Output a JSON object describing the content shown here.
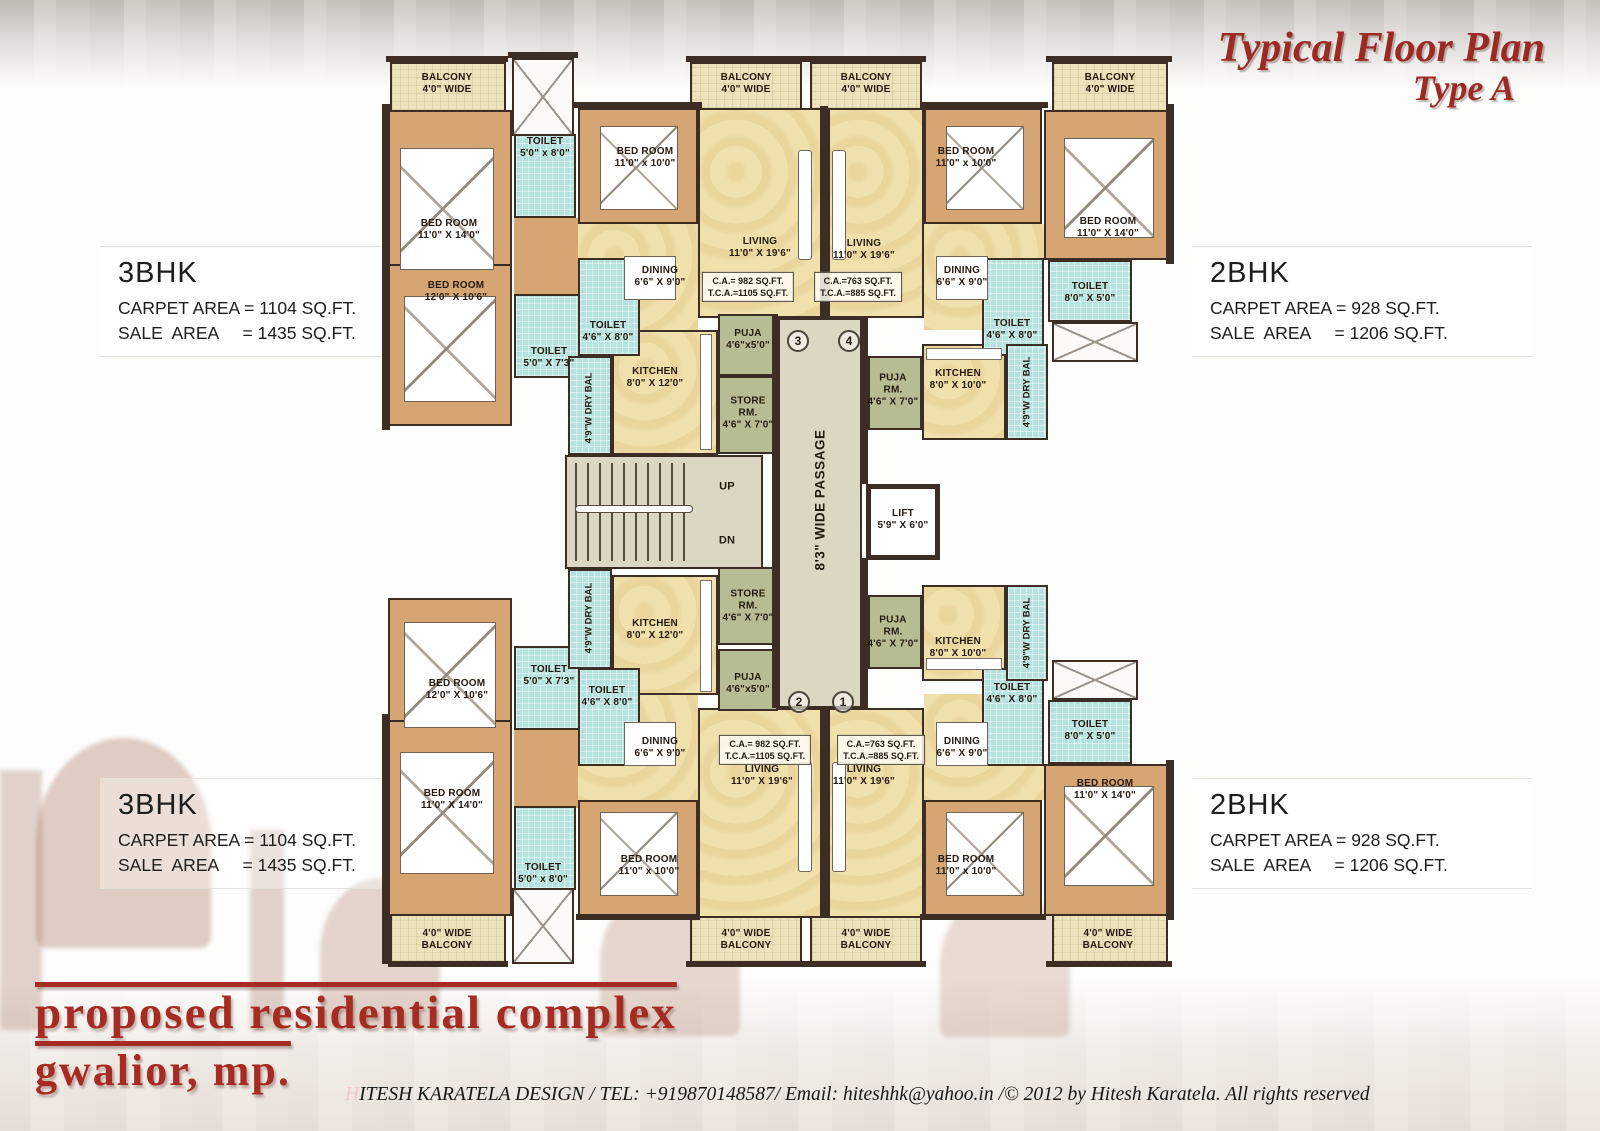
{
  "title": {
    "line1": "Typical Floor Plan",
    "line2": "Type A"
  },
  "info_blocks": {
    "top_left": {
      "name": "3BHK",
      "carpet": "CARPET AREA = 1104 SQ.FT.",
      "sale": "SALE  AREA     = 1435 SQ.FT."
    },
    "top_right": {
      "name": "2BHK",
      "carpet": "CARPET AREA = 928 SQ.FT.",
      "sale": "SALE  AREA     = 1206 SQ.FT."
    },
    "bottom_left": {
      "name": "3BHK",
      "carpet": "CARPET AREA = 1104 SQ.FT.",
      "sale": "SALE  AREA     = 1435 SQ.FT."
    },
    "bottom_right": {
      "name": "2BHK",
      "carpet": "CARPET AREA = 928 SQ.FT.",
      "sale": "SALE  AREA     = 1206 SQ.FT."
    }
  },
  "rooms": {
    "balcony": {
      "l1": "BALCONY",
      "l2": "4'0\" WIDE"
    },
    "balcony_b": {
      "l1": "4'0\" WIDE",
      "l2": "BALCONY"
    },
    "bed_11x14": {
      "l1": "BED ROOM",
      "l2": "11'0\" X 14'0\""
    },
    "bed_11x10": {
      "l1": "BED ROOM",
      "l2": "11'0\" x 10'0\""
    },
    "bed_12x10_6": {
      "l1": "BED ROOM",
      "l2": "12'0\" X 10'6\""
    },
    "living": {
      "l1": "LIVING",
      "l2": "11'0\" X 19'6\""
    },
    "dining": {
      "l1": "DINING",
      "l2": "6'6\" X 9'0\""
    },
    "kitchen_8x12": {
      "l1": "KITCHEN",
      "l2": "8'0\" X 12'0\""
    },
    "kitchen_8x10": {
      "l1": "KITCHEN",
      "l2": "8'0\" X 10'0\""
    },
    "toilet_5x8": {
      "l1": "TOILET",
      "l2": "5'0\" x 8'0\""
    },
    "toilet_4_6x8": {
      "l1": "TOILET",
      "l2": "4'6\" X 8'0\""
    },
    "toilet_5x7_3": {
      "l1": "TOILET",
      "l2": "5'0\" X 7'3\""
    },
    "toilet_8x5": {
      "l1": "TOILET",
      "l2": "8'0\" X 5'0\""
    },
    "puja": {
      "l1": "PUJA",
      "l2": "4'6\"x5'0\""
    },
    "puja_rm": {
      "l1": "PUJA",
      "l2": "RM.",
      "l3": "4'6\" X 7'0\""
    },
    "store_rm": {
      "l1": "STORE",
      "l2": "RM.",
      "l3": "4'6\" X 7'0\""
    },
    "dry_bal": "4'9\"W DRY BAL",
    "passage": "8'3\" WIDE PASSAGE",
    "lift": {
      "l1": "LIFT",
      "l2": "5'9\" X 6'0\""
    },
    "stairs_up": "UP",
    "stairs_dn": "DN"
  },
  "areas": {
    "bhk3": {
      "l1": "C.A.= 982 SQ.FT.",
      "l2": "T.C.A.=1105 SQ.FT."
    },
    "bhk2": {
      "l1": "C.A.=763 SQ.FT.",
      "l2": "T.C.A.=885 SQ.FT."
    }
  },
  "flat_numbers": {
    "n1": "1",
    "n2": "2",
    "n3": "3",
    "n4": "4"
  },
  "brand": {
    "line1": "proposed residential complex",
    "line2": "gwalior, mp."
  },
  "footer": {
    "initial": "H",
    "rest": "ITESH KARATELA DESIGN / TEL: +919870148587/ Email: hiteshhk@yahoo.in /© 2012 by Hitesh Karatela. All rights reserved"
  },
  "colors": {
    "accent_red": "#9b2a25",
    "wall": "#3c2e25",
    "bedroom": "#d5a673",
    "floor": "#f0e0ac",
    "toilet": "#b5e2de",
    "green_room": "#b6bd92",
    "balcony": "#ece3bd",
    "passage": "#dbd7c2"
  }
}
